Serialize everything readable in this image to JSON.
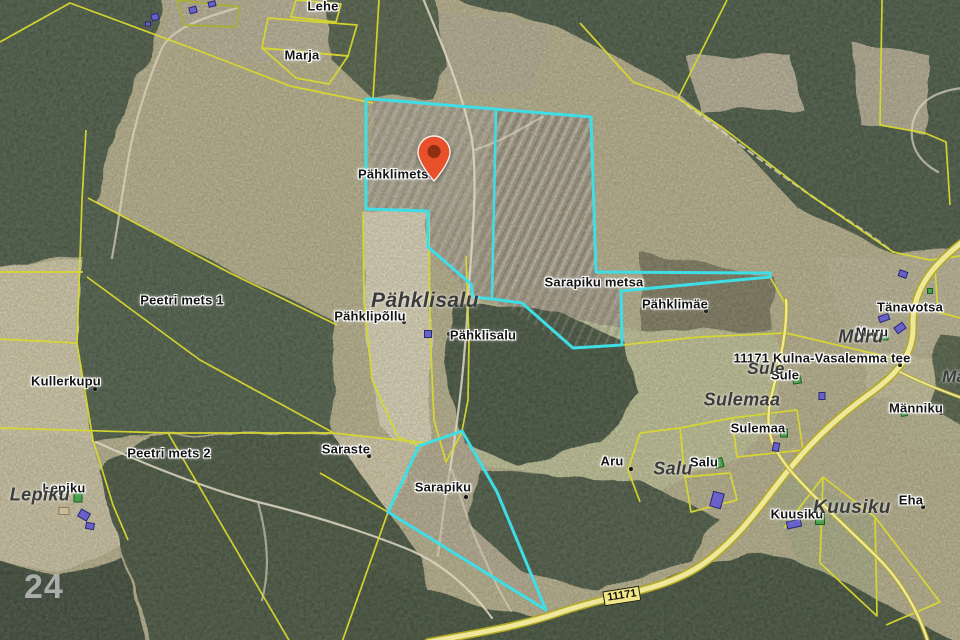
{
  "map": {
    "watermark": "24",
    "marker": {
      "name": "location-marker",
      "tip_x": 434,
      "tip_y": 181
    },
    "road_shield": {
      "text": "11171"
    },
    "colors": {
      "parcel_line_yellow": "#d9d92f",
      "highlight_cyan": "#3fdde6",
      "marker_red": "#e8502a",
      "marker_hole": "#8d2f10",
      "road_fill": "#efe79a",
      "road_casing": "#b3a922",
      "settlement_label_gray": "#3b3b3b",
      "watermark_gray": "rgba(235,235,235,0.62)"
    },
    "labels": [
      {
        "text": "Lehe",
        "x": 323,
        "y": 6,
        "style": "halo"
      },
      {
        "text": "Marja",
        "x": 302,
        "y": 55,
        "style": "halo"
      },
      {
        "text": "Pähklimetsa",
        "x": 397,
        "y": 174,
        "style": "halo"
      },
      {
        "text": "Peetri mets 1",
        "x": 182,
        "y": 300,
        "style": "halo"
      },
      {
        "text": "Kullerkupu",
        "x": 66,
        "y": 381,
        "style": "halo"
      },
      {
        "text": "Pähklipõllu",
        "x": 370,
        "y": 316,
        "style": "halo"
      },
      {
        "text": "Pähklisalu",
        "x": 483,
        "y": 335,
        "style": "halo"
      },
      {
        "text": "Sarapiku metsa",
        "x": 594,
        "y": 282,
        "style": "halo"
      },
      {
        "text": "Pähklimäe",
        "x": 675,
        "y": 304,
        "style": "halo"
      },
      {
        "text": "Tänavotsa",
        "x": 910,
        "y": 307,
        "style": "halo"
      },
      {
        "text": "Muru",
        "x": 872,
        "y": 332,
        "style": "halo"
      },
      {
        "text": "11171 Kulna-Vasalemma tee",
        "x": 822,
        "y": 358,
        "style": "halo"
      },
      {
        "text": "Sule",
        "x": 785,
        "y": 375,
        "style": "halo"
      },
      {
        "text": "Sulemaa",
        "x": 758,
        "y": 428,
        "style": "halo"
      },
      {
        "text": "Männiku",
        "x": 916,
        "y": 408,
        "style": "halo"
      },
      {
        "text": "Salu",
        "x": 704,
        "y": 462,
        "style": "halo"
      },
      {
        "text": "Aru",
        "x": 612,
        "y": 461,
        "style": "halo"
      },
      {
        "text": "Saraste",
        "x": 346,
        "y": 449,
        "style": "halo"
      },
      {
        "text": "Sarapiku",
        "x": 443,
        "y": 487,
        "style": "halo"
      },
      {
        "text": "Peetri mets 2",
        "x": 169,
        "y": 453,
        "style": "halo"
      },
      {
        "text": "Lepiku",
        "x": 64,
        "y": 488,
        "style": "halo"
      },
      {
        "text": "Kuusiku",
        "x": 797,
        "y": 514,
        "style": "halo"
      },
      {
        "text": "Eha",
        "x": 911,
        "y": 500,
        "style": "halo"
      },
      {
        "text": "Pähklisalu",
        "x": 425,
        "y": 301,
        "style": "settlement",
        "size": 21
      },
      {
        "text": "Muru",
        "x": 861,
        "y": 337,
        "style": "settlement",
        "size": 18
      },
      {
        "text": "Sule",
        "x": 766,
        "y": 369,
        "style": "settlement",
        "size": 17
      },
      {
        "text": "Sulemaa",
        "x": 742,
        "y": 400,
        "style": "settlement",
        "size": 18
      },
      {
        "text": "Salu",
        "x": 673,
        "y": 469,
        "style": "settlement",
        "size": 18
      },
      {
        "text": "Kuusiku",
        "x": 852,
        "y": 508,
        "style": "settlement",
        "size": 19
      },
      {
        "text": "Lepiku",
        "x": 40,
        "y": 495,
        "style": "settlement",
        "size": 18
      },
      {
        "text": "Männiku",
        "x": 978,
        "y": 377,
        "style": "settlement",
        "size": 17
      }
    ],
    "anchor_dots": [
      [
        95,
        389
      ],
      [
        404,
        322
      ],
      [
        449,
        334
      ],
      [
        706,
        311
      ],
      [
        900,
        365
      ],
      [
        941,
        413
      ],
      [
        631,
        469
      ],
      [
        369,
        456
      ],
      [
        466,
        497
      ],
      [
        923,
        507
      ]
    ],
    "buildings": [
      {
        "x": 155,
        "y": 17,
        "w": 8,
        "h": 7,
        "r": -20,
        "c": "purple"
      },
      {
        "x": 193,
        "y": 10,
        "w": 8,
        "h": 7,
        "r": -15,
        "c": "purple"
      },
      {
        "x": 212,
        "y": 4,
        "w": 8,
        "h": 6,
        "r": -15,
        "c": "purple"
      },
      {
        "x": 148,
        "y": 24,
        "w": 6,
        "h": 5,
        "r": 0,
        "c": "purple"
      },
      {
        "x": 903,
        "y": 274,
        "w": 9,
        "h": 7,
        "r": 20,
        "c": "purple"
      },
      {
        "x": 884,
        "y": 318,
        "w": 11,
        "h": 7,
        "r": -20,
        "c": "purple"
      },
      {
        "x": 900,
        "y": 328,
        "w": 11,
        "h": 8,
        "r": -35,
        "c": "purple"
      },
      {
        "x": 776,
        "y": 447,
        "w": 7,
        "h": 9,
        "r": 10,
        "c": "purple"
      },
      {
        "x": 717,
        "y": 500,
        "w": 12,
        "h": 16,
        "r": 15,
        "c": "purple"
      },
      {
        "x": 84,
        "y": 515,
        "w": 11,
        "h": 9,
        "r": 30,
        "c": "purple"
      },
      {
        "x": 90,
        "y": 526,
        "w": 9,
        "h": 7,
        "r": 10,
        "c": "purple"
      },
      {
        "x": 794,
        "y": 524,
        "w": 15,
        "h": 8,
        "r": -12,
        "c": "purple"
      },
      {
        "x": 428,
        "y": 334,
        "w": 8,
        "h": 8,
        "r": 0,
        "c": "purple"
      },
      {
        "x": 822,
        "y": 396,
        "w": 7,
        "h": 8,
        "r": 0,
        "c": "purple"
      },
      {
        "x": 78,
        "y": 497,
        "w": 9,
        "h": 11,
        "r": 0,
        "c": "green"
      },
      {
        "x": 797,
        "y": 380,
        "w": 9,
        "h": 8,
        "r": -10,
        "c": "green"
      },
      {
        "x": 784,
        "y": 433,
        "w": 8,
        "h": 9,
        "r": 0,
        "c": "green"
      },
      {
        "x": 719,
        "y": 463,
        "w": 9,
        "h": 10,
        "r": -15,
        "c": "green"
      },
      {
        "x": 820,
        "y": 519,
        "w": 10,
        "h": 12,
        "r": 0,
        "c": "green"
      },
      {
        "x": 885,
        "y": 337,
        "w": 7,
        "h": 7,
        "r": 0,
        "c": "green"
      },
      {
        "x": 938,
        "y": 307,
        "w": 7,
        "h": 7,
        "r": 0,
        "c": "green"
      },
      {
        "x": 930,
        "y": 291,
        "w": 6,
        "h": 6,
        "r": 0,
        "c": "green"
      },
      {
        "x": 904,
        "y": 413,
        "w": 7,
        "h": 7,
        "r": -10,
        "c": "green"
      },
      {
        "x": 64,
        "y": 511,
        "w": 11,
        "h": 8,
        "r": 0,
        "c": "tan"
      }
    ]
  }
}
